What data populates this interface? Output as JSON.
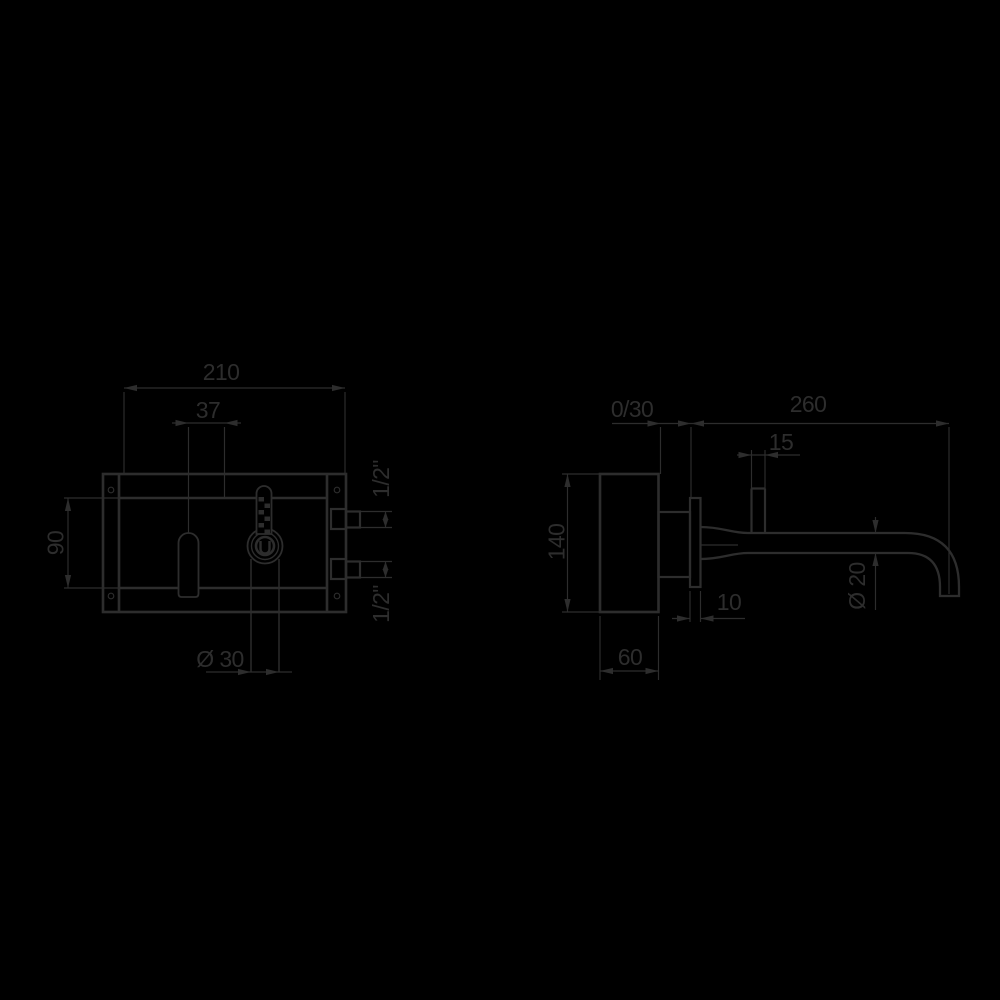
{
  "drawing": {
    "type": "technical-installation-drawing",
    "subject": "wall-mounted-basin-mixer",
    "background_color": "#000000",
    "line_color": "#2d2d2d",
    "views": {
      "front": {
        "label": "front-view-of-built-in-body",
        "dims": {
          "width": "210",
          "spout_offset": "37",
          "opening_height": "90",
          "cartridge_diameter": "Ø 30",
          "inlet_top": "1/2\"",
          "inlet_bottom": "1/2\""
        }
      },
      "side": {
        "label": "side-view-of-spout-and-body",
        "dims": {
          "adjustment_range": "0/30",
          "spout_reach": "260",
          "stub_width": "15",
          "body_height": "140",
          "plate_thickness": "10",
          "body_depth": "60",
          "spout_diameter": "Ø 20"
        }
      }
    }
  }
}
